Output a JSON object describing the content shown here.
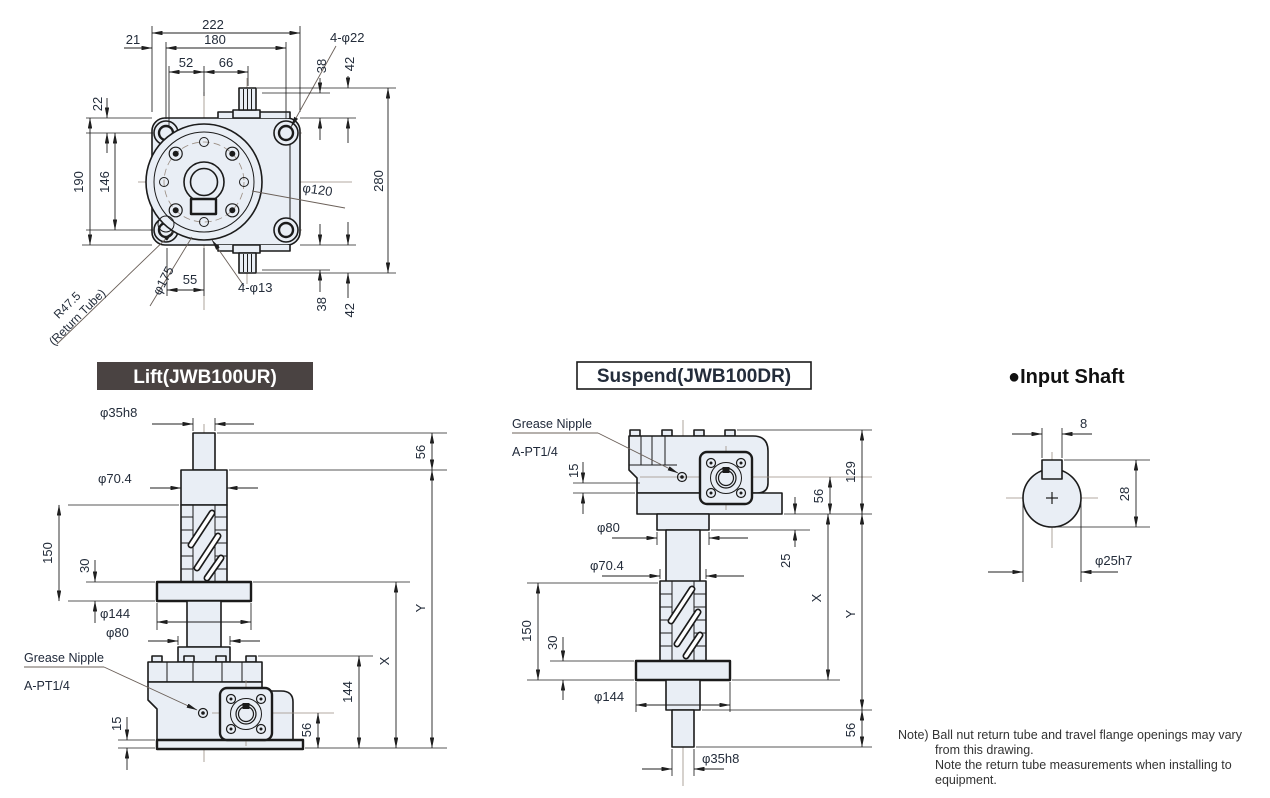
{
  "top_view": {
    "d222": "222",
    "d180": "180",
    "d21": "21",
    "d52": "52",
    "d66": "66",
    "holes_top": "4-φ22",
    "d38_top": "38",
    "d42_top": "42",
    "d22_left": "22",
    "d190": "190",
    "d146": "146",
    "d280": "280",
    "d120": "φ120",
    "d175": "φ175",
    "d55": "55",
    "holes_bottom": "4-φ13",
    "d38_bottom": "38",
    "d42_bottom": "42",
    "return_radius": "R47.5",
    "return_label": "(Return Tube)"
  },
  "lift": {
    "title": "Lift(JWB100UR)",
    "d35": "φ35h8",
    "d56_top": "56",
    "d70": "φ70.4",
    "d150": "150",
    "d30": "30",
    "d144_flange": "φ144",
    "d80": "φ80",
    "grease1": "Grease Nipple",
    "grease2": "A-PT1/4",
    "d15": "15",
    "d56_bottom": "56",
    "d144_height": "144",
    "x": "X",
    "y": "Y"
  },
  "suspend": {
    "title": "Suspend(JWB100DR)",
    "grease1": "Grease Nipple",
    "grease2": "A-PT1/4",
    "d129": "129",
    "d15": "15",
    "d56_top": "56",
    "d80": "φ80",
    "d25": "25",
    "d70": "φ70.4",
    "d150": "150",
    "d30": "30",
    "d144": "φ144",
    "d56_bottom": "56",
    "d35": "φ35h8",
    "x": "X",
    "y": "Y"
  },
  "input_shaft": {
    "title": "●Input Shaft",
    "d8": "8",
    "d28": "28",
    "d25": "φ25h7"
  },
  "note": {
    "l1": "Note) Ball nut return tube and travel flange openings may vary",
    "l2": "from this drawing.",
    "l3": "Note the return tube measurements when installing to",
    "l4": "equipment."
  }
}
